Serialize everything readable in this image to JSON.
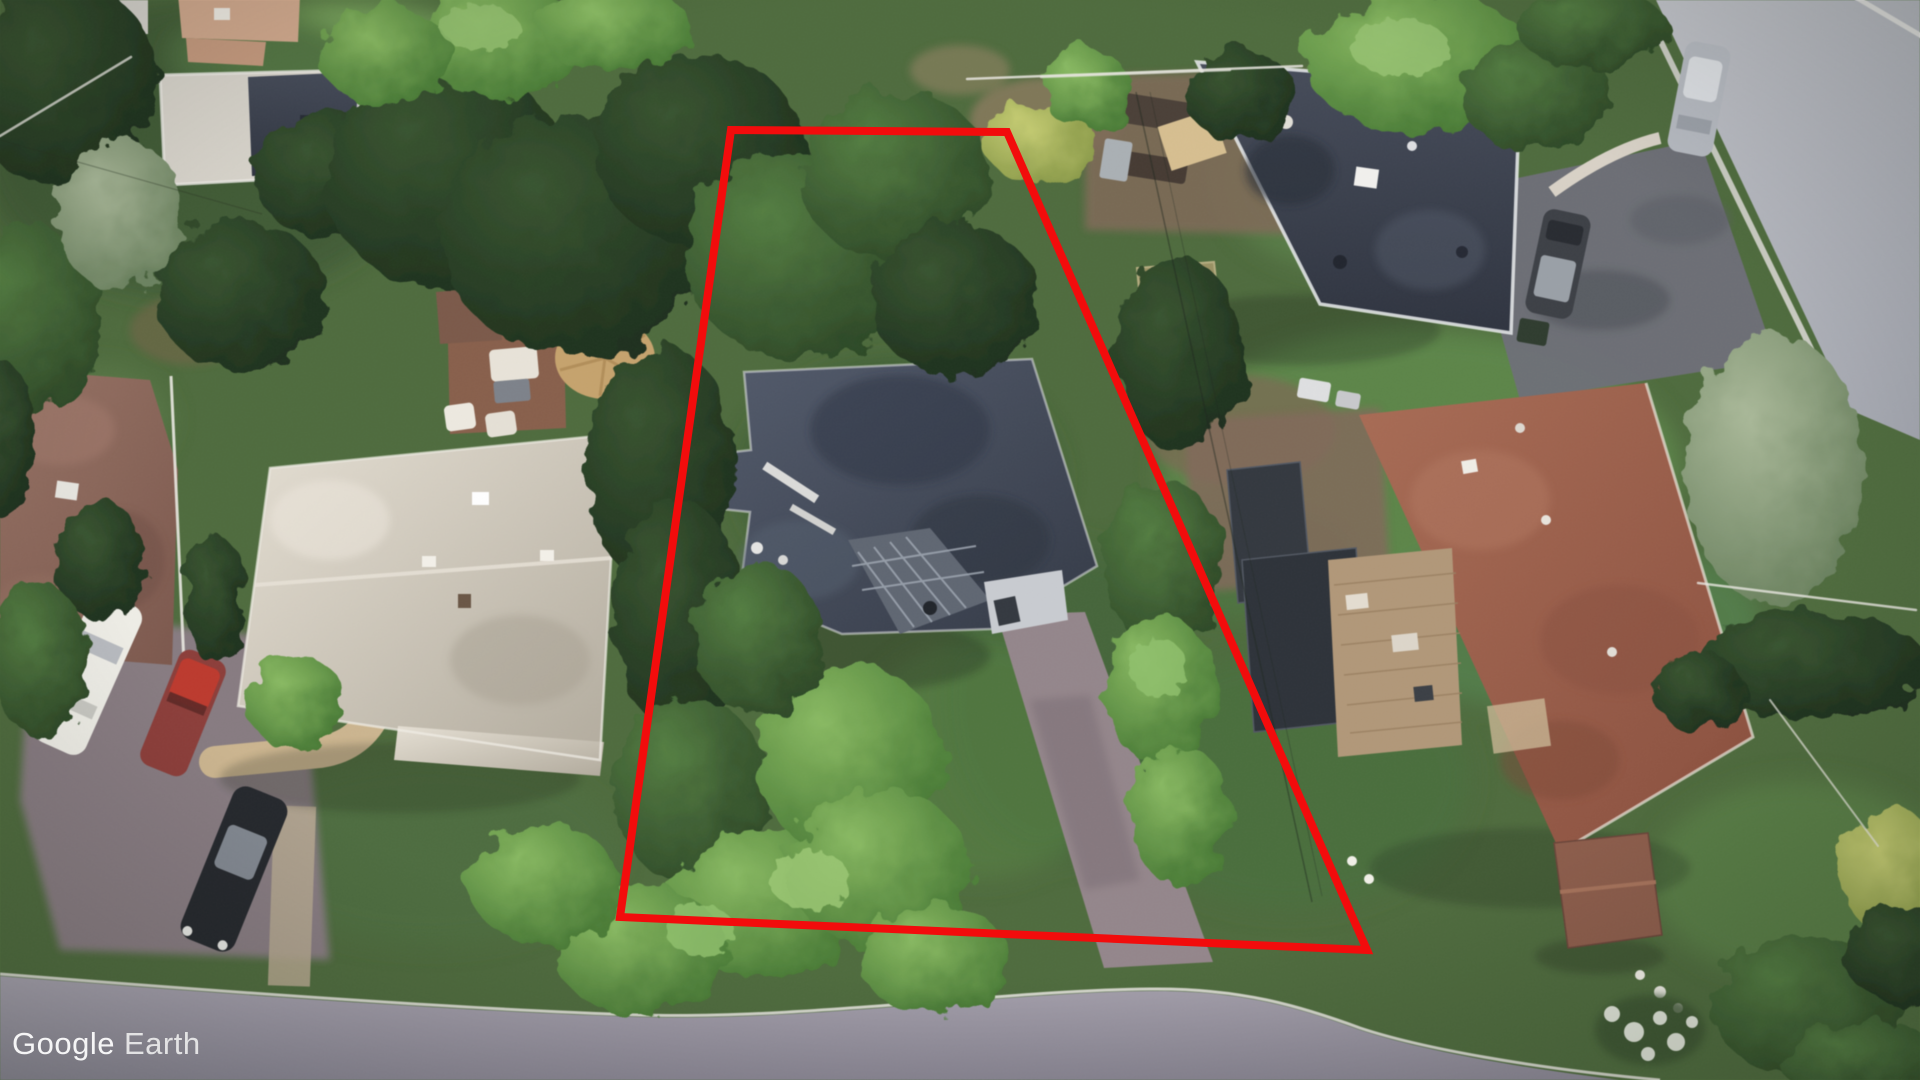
{
  "watermark": {
    "brand": "Google",
    "product": "Earth"
  },
  "map": {
    "type": "satellite-aerial-oblique",
    "provider_watermark": "Google Earth"
  },
  "boundary": {
    "label": "highlighted-property-parcel",
    "color": "#f20c0c",
    "stroke_width": 8,
    "vertices": [
      [
        731,
        130
      ],
      [
        1007,
        132
      ],
      [
        1367,
        950
      ],
      [
        620,
        917
      ]
    ],
    "points_str": "731,130 1007,132 1367,950 620,917"
  },
  "scene": {
    "roads": [
      {
        "name": "bottom-street",
        "surface_color": "#9b96a4",
        "curb_color": "#ece9e4"
      },
      {
        "name": "right-street",
        "surface_color": "#b7bac1",
        "curb_color": "#dcdad5"
      }
    ],
    "buildings": [
      {
        "name": "parcel-house",
        "roof_color": "#4a5160",
        "approx": [
          900,
          490
        ]
      },
      {
        "name": "white-roof-house-left",
        "roof_color": "#c9c2b4",
        "approx": [
          430,
          595
        ]
      },
      {
        "name": "brown-roof-house-far-left",
        "roof_color": "#8a6457",
        "approx": [
          85,
          515
        ]
      },
      {
        "name": "dark-roof-house-top-right",
        "roof_color": "#3d4250",
        "approx": [
          1355,
          190
        ]
      },
      {
        "name": "terracotta-roof-house-right",
        "roof_color": "#9e5f4a",
        "approx": [
          1555,
          615
        ]
      },
      {
        "name": "flat-roof-building-top-left",
        "roof_color": "#d9d5cc",
        "approx": [
          255,
          125
        ]
      },
      {
        "name": "tan-roof-building-top-left",
        "roof_color": "#d4a98b",
        "approx": [
          235,
          25
        ]
      },
      {
        "name": "dark-shed-right",
        "roof_color": "#32373e",
        "approx": [
          1295,
          600
        ]
      },
      {
        "name": "brown-shed-bottom-right",
        "roof_color": "#8e5c49",
        "approx": [
          1605,
          890
        ]
      }
    ],
    "vehicles": [
      {
        "name": "white-car",
        "color": "#efeee7",
        "approx": [
          88,
          674
        ]
      },
      {
        "name": "red-car",
        "color": "#c2382b",
        "approx": [
          183,
          713
        ]
      },
      {
        "name": "black-car",
        "color": "#24272c",
        "approx": [
          234,
          869
        ]
      },
      {
        "name": "gray-car-on-right-street",
        "color": "#b6bac1",
        "approx": [
          1699,
          99
        ]
      },
      {
        "name": "dark-suv-right-driveway",
        "color": "#3c3f45",
        "approx": [
          1558,
          264
        ]
      }
    ],
    "features": [
      {
        "name": "round-tan-patio-umbrella",
        "color": "#c8a36a",
        "approx": [
          605,
          358
        ]
      },
      {
        "name": "square-tan-umbrella-top-right",
        "color": "#d8bf8e",
        "approx": [
          1192,
          140
        ]
      },
      {
        "name": "sandbox-fire-pit",
        "color": "#9a9161",
        "approx": [
          1178,
          292
        ]
      },
      {
        "name": "wood-deck-left",
        "color": "#8a5f4a",
        "approx": [
          505,
          365
        ]
      },
      {
        "name": "wood-deck-right",
        "color": "#b29776",
        "approx": [
          1395,
          650
        ]
      },
      {
        "name": "white-flower-bushes",
        "color": "#eef0e6",
        "approx": [
          1650,
          1025
        ]
      }
    ]
  }
}
